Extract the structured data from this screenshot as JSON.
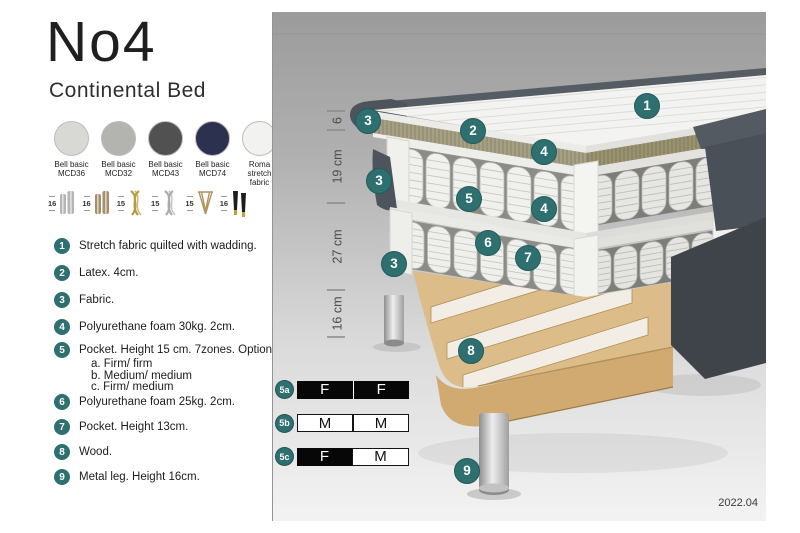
{
  "header": {
    "title": "No4",
    "subtitle": "Continental Bed"
  },
  "swatches": [
    {
      "line1": "Bell basic",
      "line2": "MCD36",
      "color": "#d8d8d4"
    },
    {
      "line1": "Bell basic",
      "line2": "MCD32",
      "color": "#b3b3af"
    },
    {
      "line1": "Bell basic",
      "line2": "MCD43",
      "color": "#515151"
    },
    {
      "line1": "Bell basic",
      "line2": "MCD74",
      "color": "#2c3150"
    },
    {
      "line1": "Roma",
      "line2": "stretch fabric",
      "color": "#f2f2f1"
    }
  ],
  "legs": [
    {
      "size": "16",
      "type": "cylinder-silver"
    },
    {
      "size": "16",
      "type": "cylinder-bronze"
    },
    {
      "size": "15",
      "type": "twist-gold"
    },
    {
      "size": "15",
      "type": "twist-silver"
    },
    {
      "size": "15",
      "type": "hairpin-gold"
    },
    {
      "size": "16",
      "type": "black-gold"
    }
  ],
  "features": [
    {
      "num": "1",
      "text": "Stretch fabric quilted with wadding."
    },
    {
      "num": "2",
      "text": "Latex. 4cm."
    },
    {
      "num": "3",
      "text": "Fabric."
    },
    {
      "num": "4",
      "text": "Polyurethane foam 30kg. 2cm."
    },
    {
      "num": "5",
      "text": "Pocket. Height 15 cm. 7zones. Option:",
      "options": [
        "a. Firm/ firm",
        "b. Medium/ medium",
        "c. Firm/ medium"
      ]
    },
    {
      "num": "6",
      "text": "Polyurethane foam 25kg. 2cm."
    },
    {
      "num": "7",
      "text": "Pocket. Height 13cm."
    },
    {
      "num": "8",
      "text": "Wood."
    },
    {
      "num": "9",
      "text": "Metal leg. Height 16cm."
    }
  ],
  "diagram": {
    "dimensions": [
      "6",
      "19 cm",
      "27 cm",
      "16 cm"
    ],
    "callouts": [
      "1",
      "2",
      "3",
      "4",
      "5",
      "6",
      "7",
      "8",
      "9"
    ],
    "firmness": [
      {
        "id": "5a",
        "cells": [
          {
            "label": "F",
            "filled": true
          },
          {
            "label": "F",
            "filled": true
          }
        ]
      },
      {
        "id": "5b",
        "cells": [
          {
            "label": "M",
            "filled": false
          },
          {
            "label": "M",
            "filled": false
          }
        ]
      },
      {
        "id": "5c",
        "cells": [
          {
            "label": "F",
            "filled": true
          },
          {
            "label": "M",
            "filled": false
          }
        ]
      }
    ],
    "version": "2022.04"
  },
  "colors": {
    "accent_teal": "#2e6f70",
    "fabric_dark": "#4e545c",
    "latex": "#a6a084",
    "wood": "#dcbc88",
    "tick": "#8a8a8a",
    "dim_text": "#4c4c4c"
  }
}
